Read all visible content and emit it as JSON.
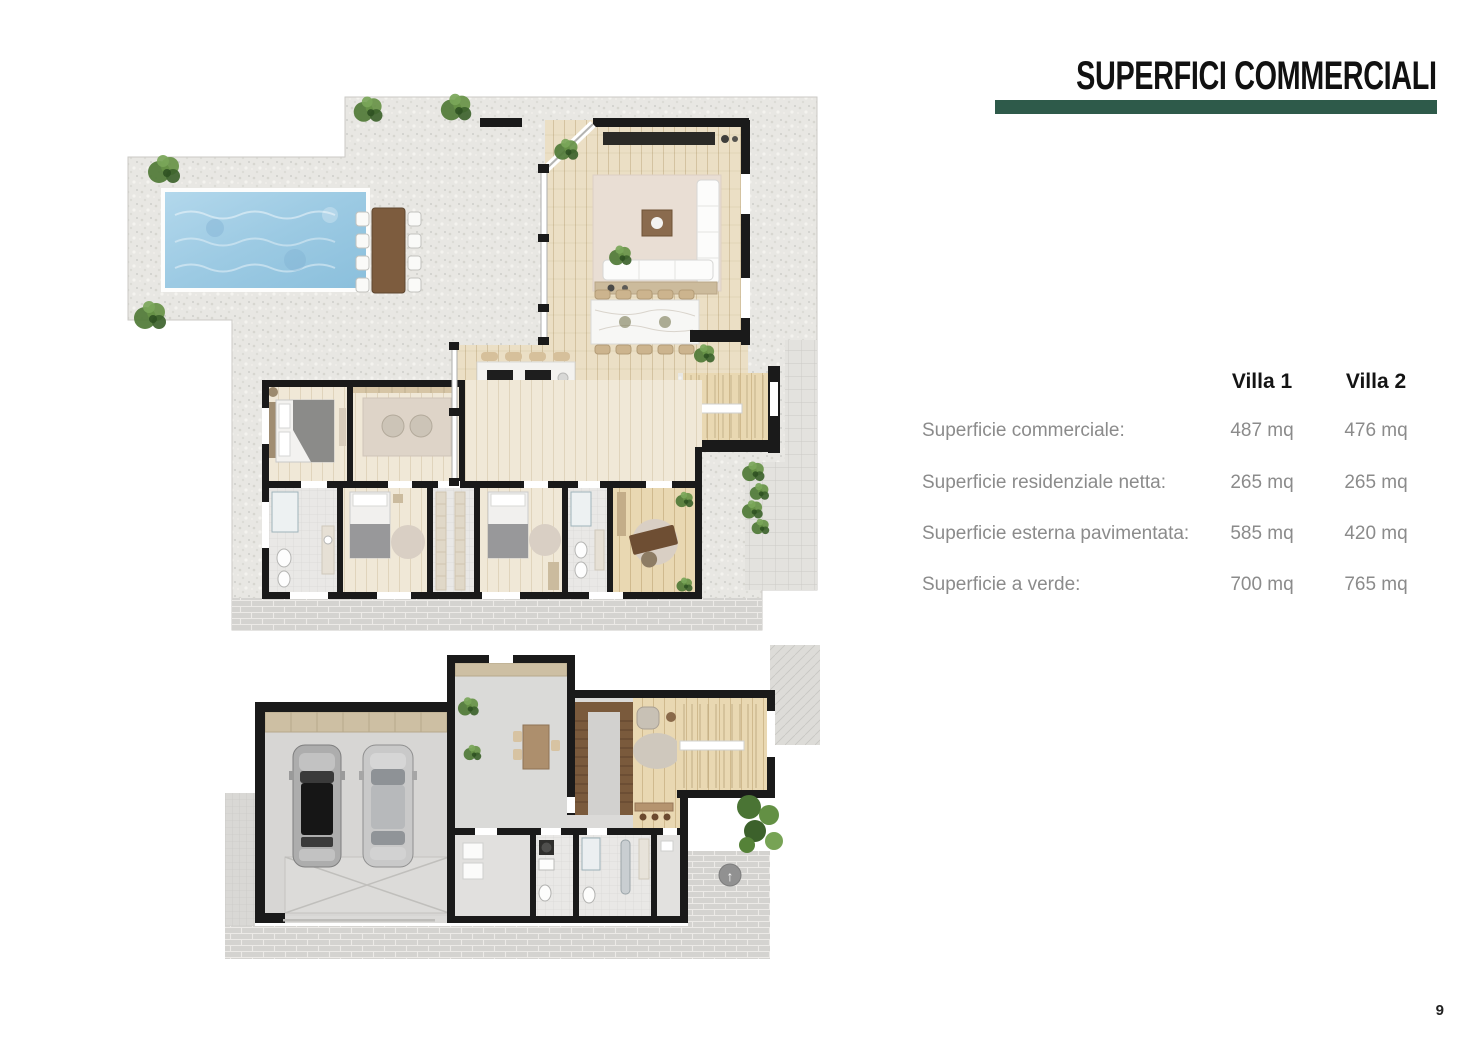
{
  "header": {
    "title": "SUPERFICI COMMERCIALI"
  },
  "villa_table": {
    "columns": [
      "Villa 1",
      "Villa 2"
    ],
    "rows": [
      {
        "label": "Superficie commerciale:",
        "villa1": "487 mq",
        "villa2": "476 mq"
      },
      {
        "label": "Superficie residenziale netta:",
        "villa1": "265 mq",
        "villa2": "265 mq"
      },
      {
        "label": "Superficie esterna pavimentata:",
        "villa1": "585 mq",
        "villa2": "420 mq"
      },
      {
        "label": "Superficie a verde:",
        "villa1": "700 mq",
        "villa2": "765 mq"
      }
    ]
  },
  "footer": {
    "page_number": "9"
  },
  "icons": {
    "north_arrow": "↑"
  },
  "colors": {
    "accent_green": "#2E5A4A",
    "pool_blue": "#9CC9E4",
    "wall_black": "#1A1A1A",
    "label_gray": "#8B8B8B",
    "wood": "#EBDFC5",
    "stone": "#E8E7E3"
  }
}
